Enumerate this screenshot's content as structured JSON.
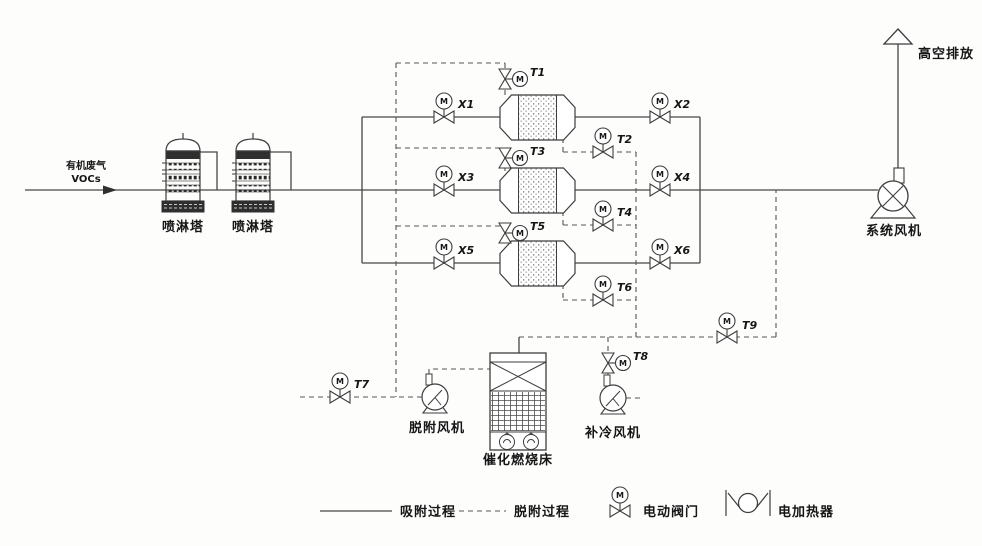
{
  "inlet": {
    "line1": "有机废气",
    "line2": "VOCs"
  },
  "outlet": {
    "label": "高空排放"
  },
  "equipment": {
    "tower1": "喷淋塔",
    "tower2": "喷淋塔",
    "desorption_fan": "脱附风机",
    "catalytic_bed": "催化燃烧床",
    "cooling_fan": "补冷风机",
    "system_fan": "系统风机"
  },
  "valves": {
    "x1": "X1",
    "x2": "X2",
    "x3": "X3",
    "x4": "X4",
    "x5": "X5",
    "x6": "X6",
    "t1": "T1",
    "t2": "T2",
    "t3": "T3",
    "t4": "T4",
    "t5": "T5",
    "t6": "T6",
    "t7": "T7",
    "t8": "T8",
    "t9": "T9"
  },
  "symbols": {
    "motor_mark": "M"
  },
  "legend": {
    "adsorption": "吸附过程",
    "desorption": "脱附过程",
    "valve": "电动阀门",
    "heater": "电加热器"
  }
}
